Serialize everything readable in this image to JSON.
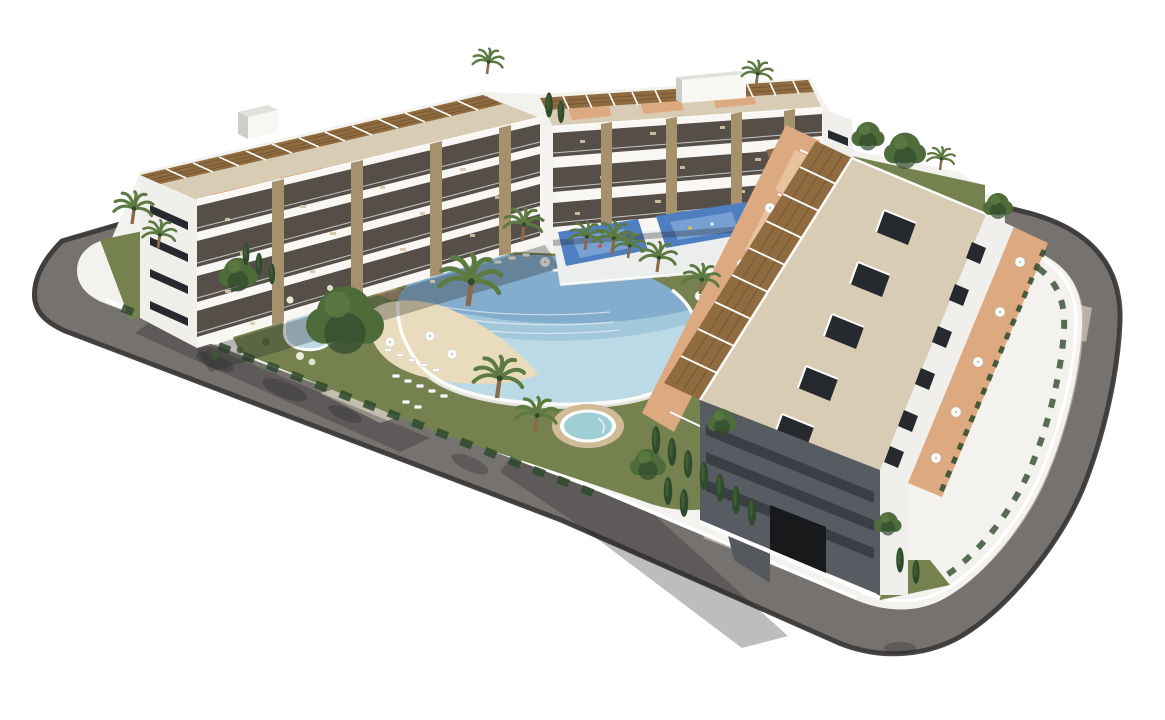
{
  "scene": {
    "type": "architectural-3d-render",
    "description": "Aerial 3D architectural rendering of a modern white apartment complex: three low-rise blocks with rooftop pergola terraces, a central landscaped courtyard with a lagoon-style swimming pool with beach entry, a round jacuzzi pool, a small pond, lawns with sun loungers and parasols, palm and cypress trees, all enclosed by a curving gray asphalt road with beige sidewalk on a white background",
    "elements": {
      "buildings": [
        "left-apartment-block",
        "center-apartment-block",
        "right-apartment-block"
      ],
      "water": [
        "lagoon-pool-with-beach-entry",
        "round-jacuzzi",
        "kidney-pond"
      ],
      "amenities": [
        "sun-loungers",
        "parasols",
        "blue-splash-pad",
        "rooftop-pergolas",
        "garage-ramp"
      ],
      "vegetation": [
        "palm-trees",
        "cypress-trees",
        "deciduous-trees",
        "hedges",
        "lawns"
      ],
      "infrastructure": [
        "perimeter-road",
        "sidewalk",
        "driveway",
        "perimeter-walls"
      ]
    }
  },
  "colors": {
    "background": "#ffffff",
    "roadAsphalt": "#767270",
    "curbDark": "#3c3a38",
    "sidewalk": "#b5ab9d",
    "driveway": "#c8c1b4",
    "shadowSoft": "rgba(35,38,36,0.30)",
    "platform": "#f3f2ee",
    "wallWhite": "#ffffff",
    "lawn": "#75814e",
    "lawnDark": "#5a6a3c",
    "treeGreen": "#4e6b3a",
    "treeDark": "#2f4a2c",
    "palmGreen": "#5d7a42",
    "trunk": "#8a6a4a",
    "stone": "#a5916c",
    "slabWhite": "#f8f7f4",
    "bldgWhite": "#f1efeb",
    "graySide": "#cfcdc8",
    "shadeFace": "#575c62",
    "shadeStrip": "#3a3f44",
    "winDark": "#26292d",
    "balconyDark": "#564f48",
    "pergola": "#8f6b3f",
    "pergolaDark": "#6e5230",
    "roofDeck": "#d9ccb4",
    "terracotta": "#dca981",
    "terracottaLight": "#e8c29d",
    "poolWater": "#bcdae6",
    "poolDeep": "#7fa9cb",
    "poolMid": "#9ec4d8",
    "sand": "#e9dcbc",
    "rimWhite": "#fbfbf9",
    "deckGray": "#e6e4de",
    "jacuzzi": "#9fcfd4",
    "tanRim": "#cfbb97",
    "blueCourt": "#4f7fc0",
    "blueCourtLight": "#7fa6d6",
    "garageDark": "#17191b",
    "rampGray": "#55595d",
    "furniture": "#d8c5a8"
  }
}
